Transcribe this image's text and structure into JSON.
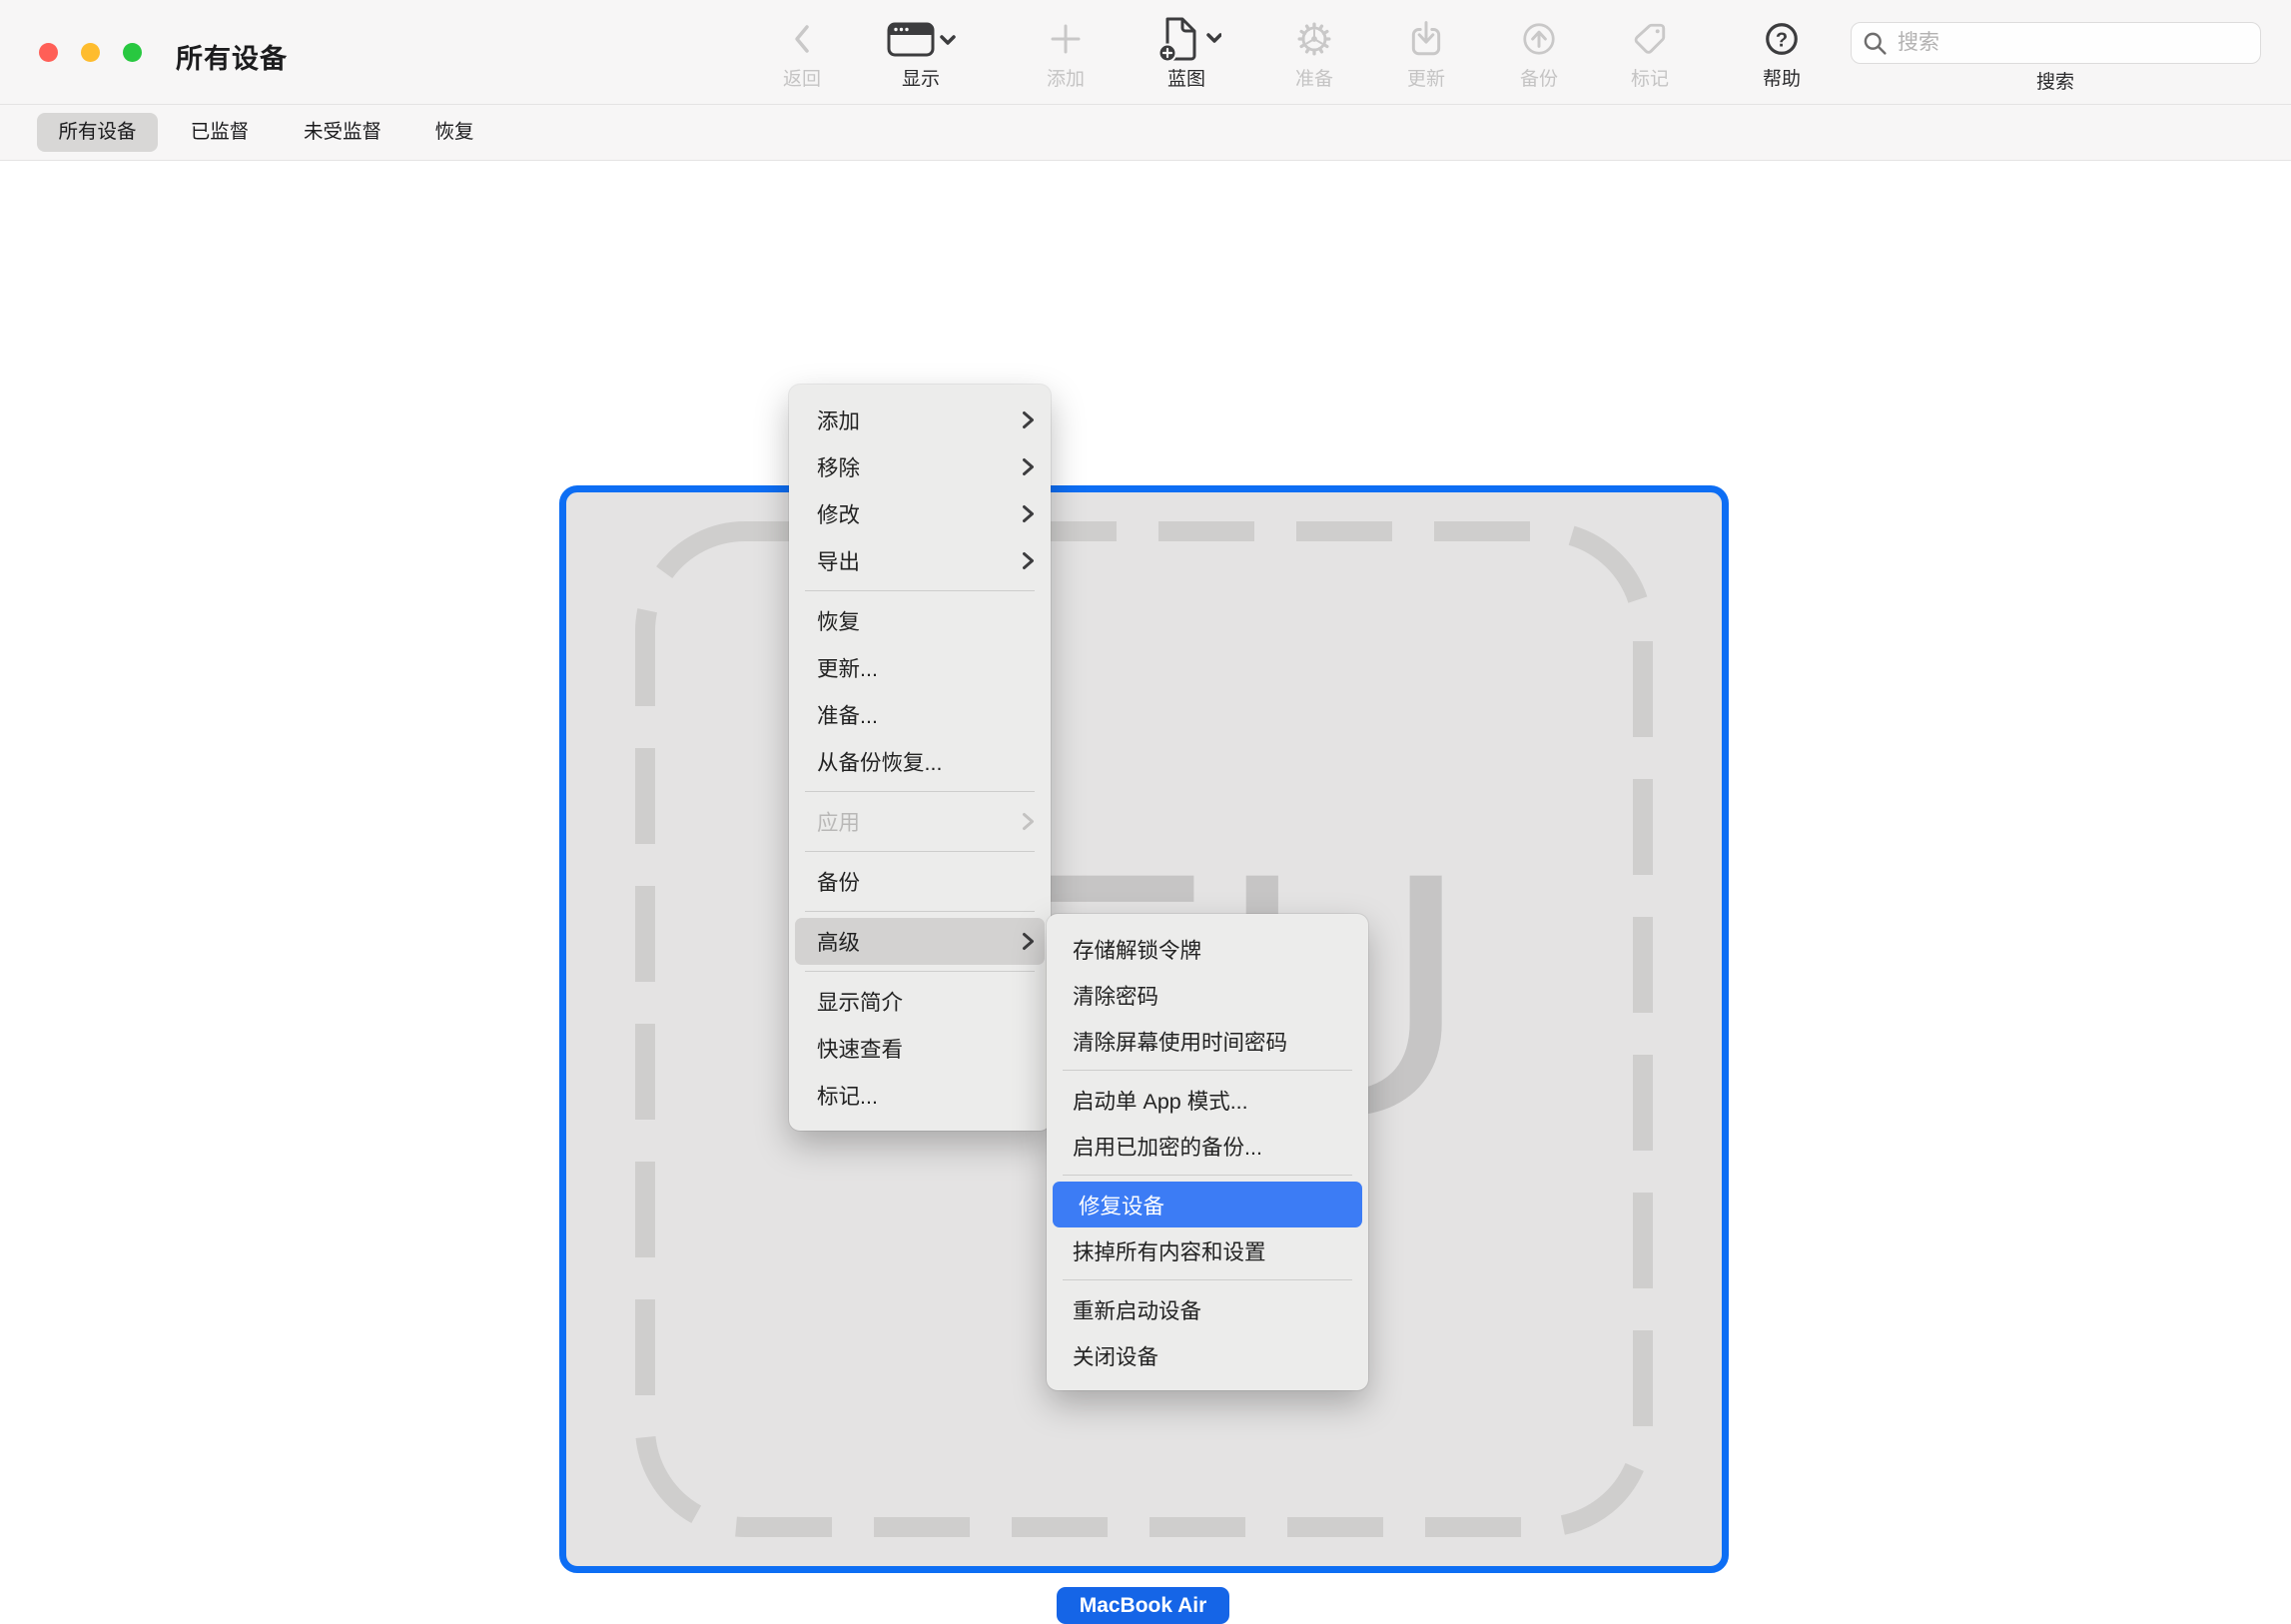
{
  "window": {
    "title": "所有设备"
  },
  "toolbar": {
    "items": [
      {
        "label": "返回",
        "icon": "back-chevron-icon",
        "enabled": false
      },
      {
        "label": "显示",
        "icon": "window-icon",
        "enabled": true,
        "has_dropdown": true
      },
      {
        "label": "添加",
        "icon": "plus-icon",
        "enabled": false
      },
      {
        "label": "蓝图",
        "icon": "document-plus-icon",
        "enabled": true,
        "has_dropdown": true
      },
      {
        "label": "准备",
        "icon": "gear-icon",
        "enabled": false
      },
      {
        "label": "更新",
        "icon": "download-tray-icon",
        "enabled": false
      },
      {
        "label": "备份",
        "icon": "arrow-up-circle-icon",
        "enabled": false
      },
      {
        "label": "标记",
        "icon": "tag-icon",
        "enabled": false
      },
      {
        "label": "帮助",
        "icon": "question-circle-icon",
        "enabled": true
      }
    ],
    "search": {
      "placeholder": "搜索",
      "label": "搜索",
      "value": ""
    }
  },
  "tab_bar": {
    "tabs": [
      {
        "label": "所有设备",
        "selected": true
      },
      {
        "label": "已监督",
        "selected": false
      },
      {
        "label": "未受监督",
        "selected": false
      },
      {
        "label": "恢复",
        "selected": false
      }
    ]
  },
  "device": {
    "name": "MacBook Air",
    "placeholder_initials": "EU",
    "selected": true,
    "selection_color": "#0d6ef4",
    "name_badge_color": "#1565e7"
  },
  "context_menu": {
    "items": [
      {
        "label": "添加",
        "has_submenu": true
      },
      {
        "label": "移除",
        "has_submenu": true
      },
      {
        "label": "修改",
        "has_submenu": true
      },
      {
        "label": "导出",
        "has_submenu": true
      },
      {
        "label": "恢复"
      },
      {
        "label": "更新..."
      },
      {
        "label": "准备..."
      },
      {
        "label": "从备份恢复..."
      },
      {
        "label": "应用",
        "has_submenu": true,
        "disabled": true
      },
      {
        "label": "备份"
      },
      {
        "label": "高级",
        "has_submenu": true,
        "highlighted": true
      },
      {
        "label": "显示简介"
      },
      {
        "label": "快速查看"
      },
      {
        "label": "标记..."
      }
    ],
    "highlight_color": "#d3d2d1"
  },
  "advanced_submenu": {
    "items": [
      {
        "label": "存储解锁令牌"
      },
      {
        "label": "清除密码"
      },
      {
        "label": "清除屏幕使用时间密码"
      },
      {
        "label": "启动单 App 模式..."
      },
      {
        "label": "启用已加密的备份..."
      },
      {
        "label": "修复设备",
        "highlighted": true
      },
      {
        "label": "抹掉所有内容和设置"
      },
      {
        "label": "重新启动设备"
      },
      {
        "label": "关闭设备"
      }
    ],
    "highlight_color": "#3c7cf5"
  }
}
